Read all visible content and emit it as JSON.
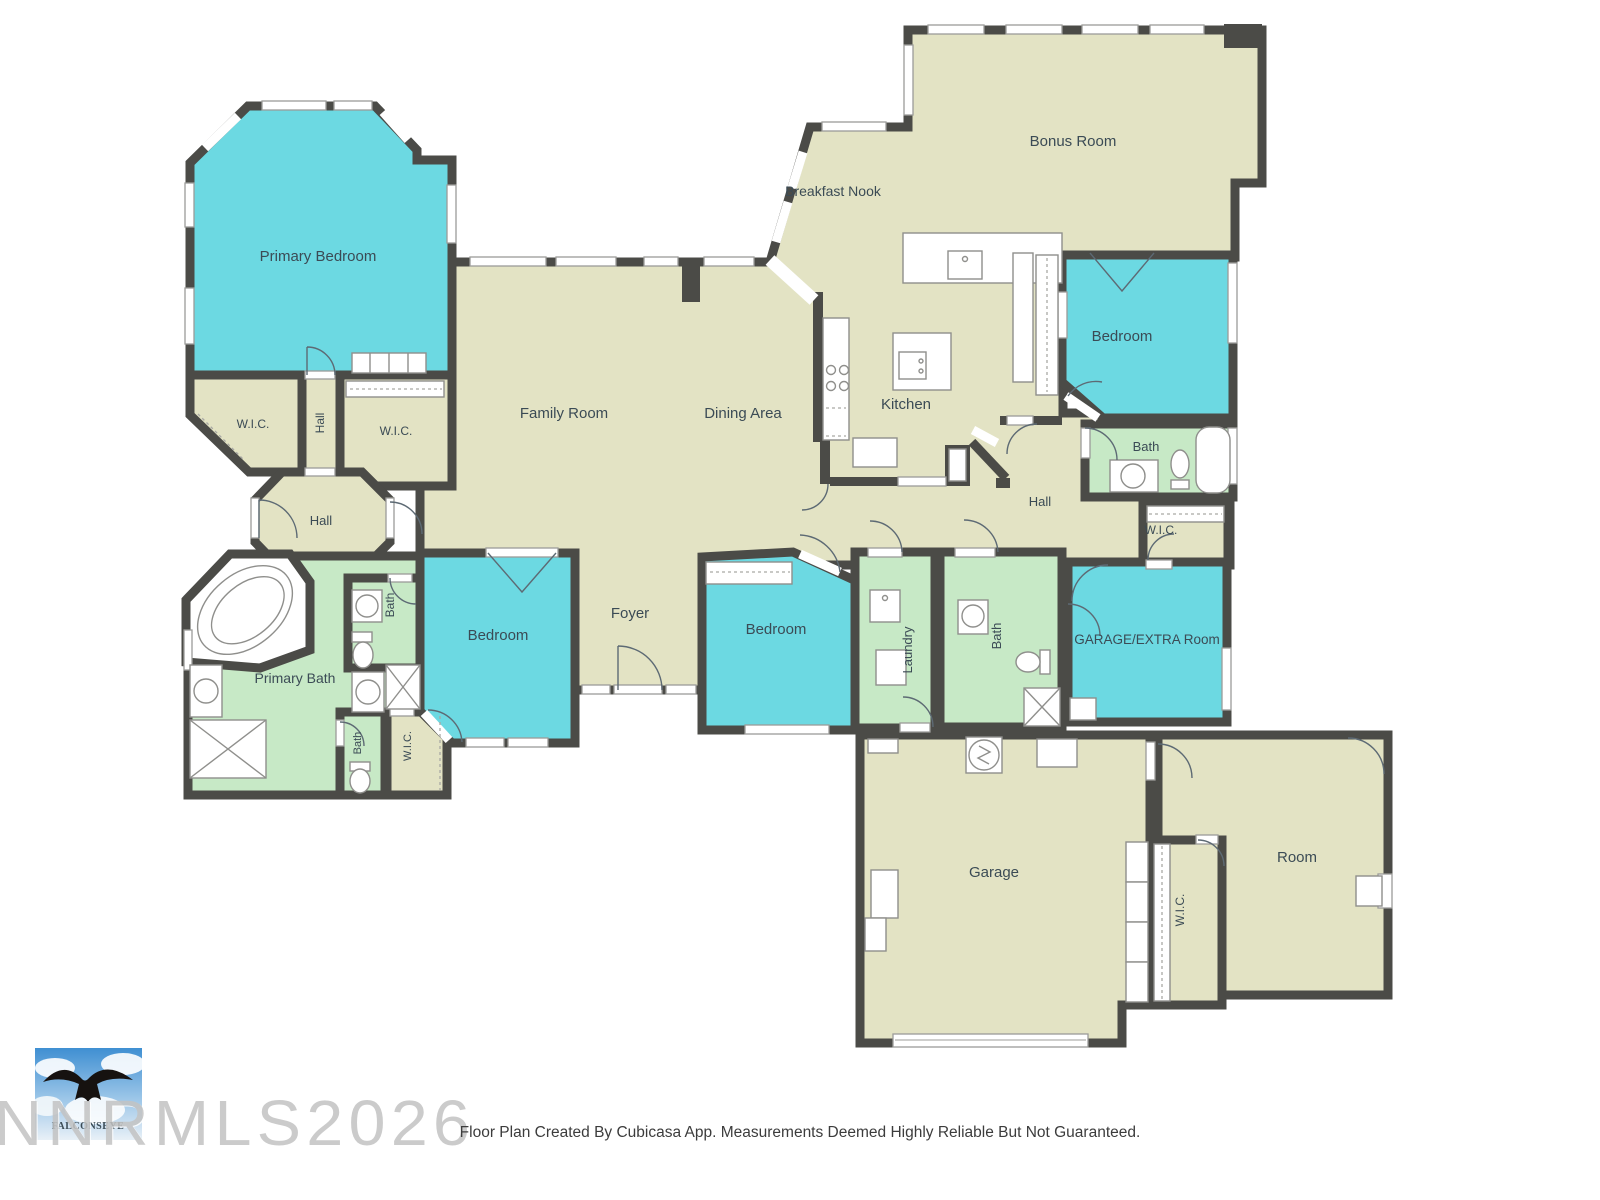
{
  "colors": {
    "wall": "#4b4b47",
    "room_beige": "#e3e3c4",
    "room_cyan": "#6cd9e2",
    "room_green": "#c7e9c6",
    "label": "#3b4b55"
  },
  "rooms": [
    {
      "label": "Primary Bedroom"
    },
    {
      "label": "W.I.C."
    },
    {
      "label": "Hall"
    },
    {
      "label": "W.I.C."
    },
    {
      "label": "Hall"
    },
    {
      "label": "Primary Bath"
    },
    {
      "label": "Bath"
    },
    {
      "label": "Bedroom"
    },
    {
      "label": "Bath"
    },
    {
      "label": "W.I.C."
    },
    {
      "label": "Foyer"
    },
    {
      "label": "Family Room"
    },
    {
      "label": "Dining Area"
    },
    {
      "label": "Kitchen"
    },
    {
      "label": "Breakfast Nook"
    },
    {
      "label": "Bonus Room"
    },
    {
      "label": "Bedroom"
    },
    {
      "label": "Bath"
    },
    {
      "label": "Hall"
    },
    {
      "label": "W.I.C."
    },
    {
      "label": "Bedroom"
    },
    {
      "label": "Laundry"
    },
    {
      "label": "Bath"
    },
    {
      "label": "GARAGE/EXTRA Room"
    },
    {
      "label": "Garage"
    },
    {
      "label": "W.I.C."
    },
    {
      "label": "Room"
    }
  ],
  "watermark": {
    "text": "NNRMLS2026"
  },
  "logo": {
    "text": "FALCONSEYE"
  },
  "footer": {
    "text": "Floor Plan Created By Cubicasa App. Measurements Deemed Highly Reliable But Not Guaranteed."
  }
}
